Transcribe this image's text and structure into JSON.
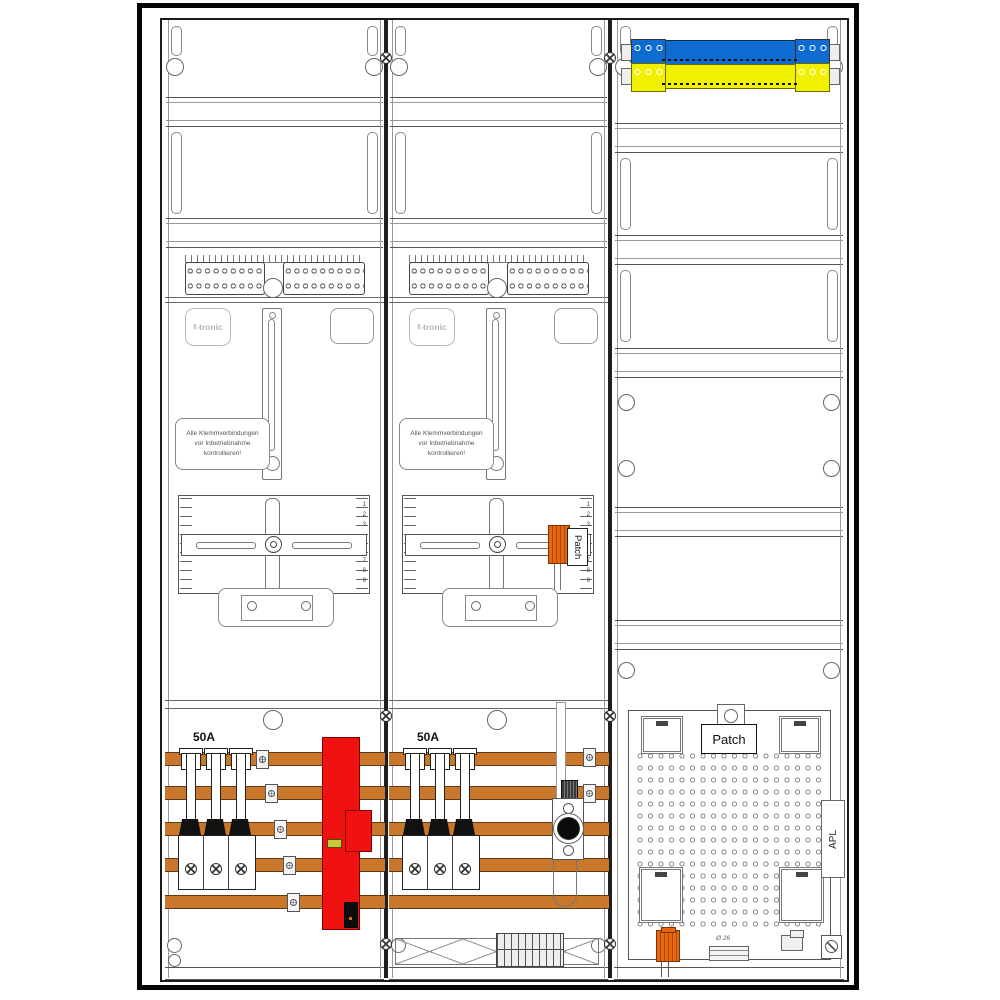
{
  "drawing": {
    "brand": "f-tronic",
    "warning_lines": [
      "Alle Klemmverbindungen",
      "vor Inbetriebnahme",
      "kontrollieren!"
    ],
    "breaker_rating": "50A",
    "patch_module_label": "Patch",
    "patch_field_label": "Patch",
    "apl_label": "APL",
    "diameter_label": "Ø 26",
    "meter_scale": {
      "top": [
        "1",
        "2",
        "3"
      ],
      "bottom": [
        "7",
        "8",
        "9"
      ]
    },
    "colors": {
      "busbar_orange": "#c9782b",
      "sls_red": "#f01111",
      "n_rail_blue": "#0e6bd0",
      "pe_rail_yellow": "#f0f000",
      "connector_orange": "#e8660d",
      "line_grey": "#555555"
    }
  }
}
